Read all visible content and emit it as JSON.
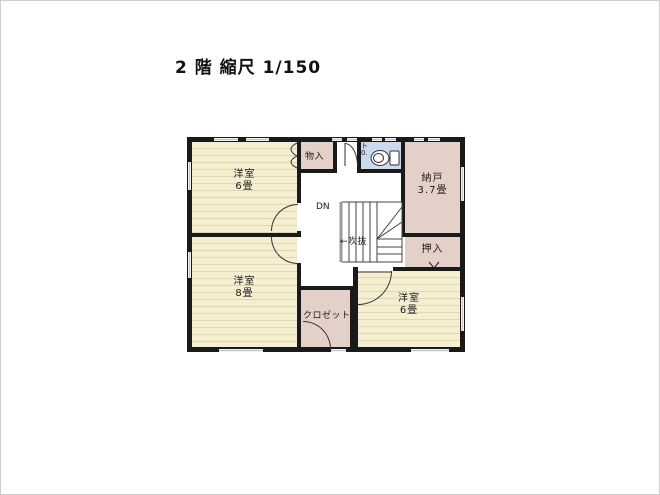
{
  "title": "2 階 縮尺 1/150",
  "floor_plan": {
    "rooms": {
      "bedroom_nw": {
        "name": "洋室",
        "size": "6畳"
      },
      "bedroom_sw": {
        "name": "洋室",
        "size": "8畳"
      },
      "bedroom_se": {
        "name": "洋室",
        "size": "6畳"
      },
      "storage_room": {
        "name": "納戸",
        "size": "3.7畳"
      },
      "oshiire_closet": {
        "name": "押入"
      },
      "hall_storage": {
        "name": "物入"
      },
      "closet": {
        "name": "クロゼット"
      },
      "toilet": {
        "label_top": "ト",
        "label_bottom": "0."
      }
    },
    "stairs": {
      "down_label": "DN"
    },
    "atrium": {
      "arrow": "←",
      "label": "吹抜"
    }
  },
  "colors": {
    "bedroom_floor": "#f6eed1",
    "storage_floor": "#e3d1c9",
    "toilet_floor": "#ccdaee",
    "wall": "#1a1a1a",
    "window_mark": "#c6c6c6"
  }
}
